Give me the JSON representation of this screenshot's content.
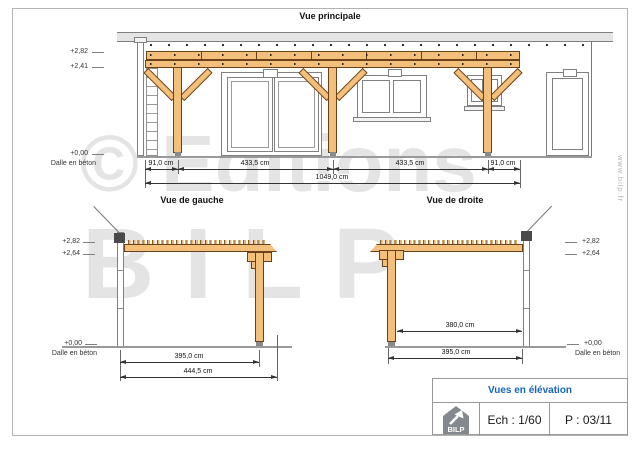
{
  "header": {
    "title": "Vue principale"
  },
  "views": {
    "main": {
      "levels": {
        "l282": "+2,82",
        "l241": "+2,41",
        "l000": "+0,00",
        "dalle": "Dalle en béton"
      },
      "dims": {
        "seg1": "91,0 cm",
        "seg2": "433,5 cm",
        "seg3": "433,5 cm",
        "seg4": "91,0 cm",
        "total": "1049,0 cm"
      }
    },
    "left": {
      "title": "Vue de gauche",
      "levels": {
        "l282": "+2,82",
        "l264": "+2,64",
        "l000": "+0,00",
        "dalle": "Dalle en béton"
      },
      "dims": {
        "inner": "395,0 cm",
        "outer": "444,5 cm"
      }
    },
    "right": {
      "title": "Vue de droite",
      "levels": {
        "l282": "+2,82",
        "l264": "+2,64",
        "l000": "+0,00",
        "dalle": "Dalle en béton"
      },
      "dims": {
        "inner": "380,0 cm",
        "outer": "395,0 cm"
      }
    }
  },
  "watermark": {
    "line1": "© Editions",
    "line2": "BILP"
  },
  "website": "www.bilp.fr",
  "title_block": {
    "title": "Vues en élévation",
    "logo": "BILP",
    "scale": "Ech : 1/60",
    "page": "P : 03/11"
  },
  "colors": {
    "accent": "#1565c0",
    "wood": "#f3c07c"
  }
}
